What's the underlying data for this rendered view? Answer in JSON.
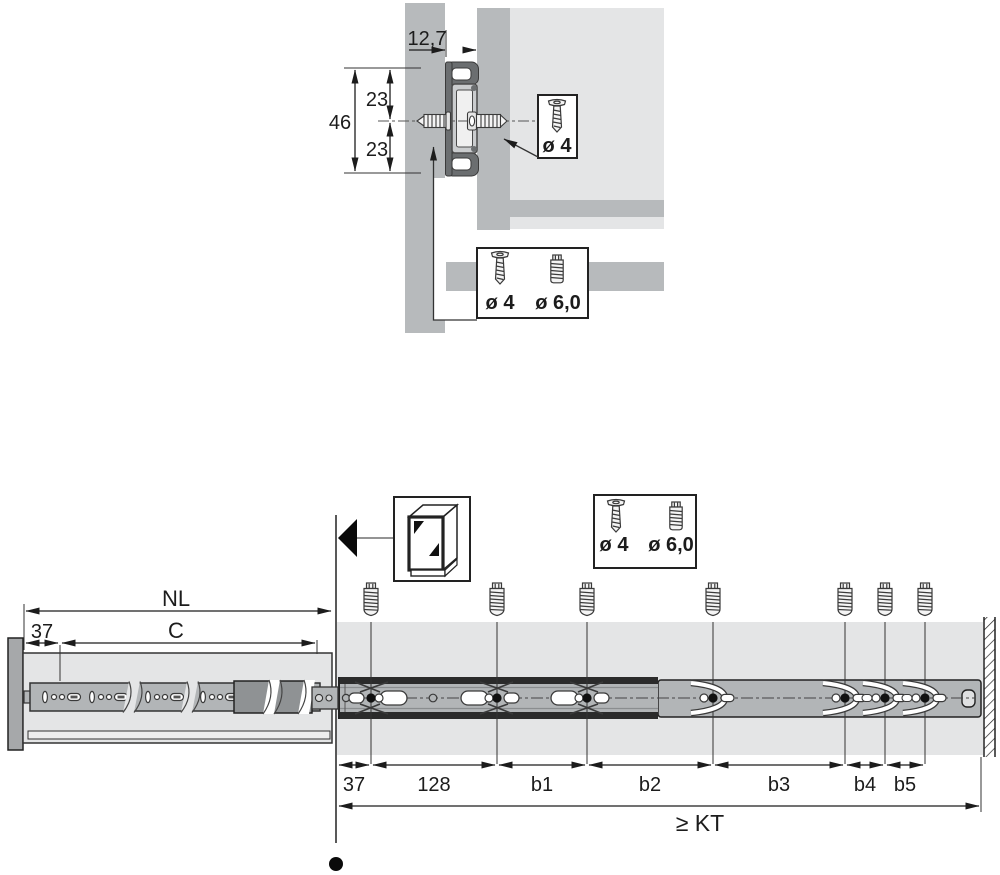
{
  "colors": {
    "panel_gray": "#b7babc",
    "panel_dark": "#a6a8aa",
    "light_gray": "#e4e5e6",
    "rail_gray": "#b2b5b7",
    "rail_dark": "#8f9294",
    "outline": "#222222",
    "black": "#111111"
  },
  "top": {
    "gap_width": "12,7",
    "height_total": "46",
    "height_upper": "23",
    "height_lower": "23",
    "box_drawer_screw": {
      "label": "ø 4",
      "icon": "countersunk-screw-icon"
    },
    "box_side_screws": {
      "label_1": "ø 4",
      "label_2": "ø 6,0",
      "icon_1": "countersunk-screw-icon",
      "icon_2": "pan-head-screw-icon"
    }
  },
  "bottom": {
    "len_nominal": "NL",
    "len_c": "C",
    "front_offset": "37",
    "cabinet_icon": "cabinet-3d-icon",
    "box_side_screws": {
      "label_1": "ø 4",
      "label_2": "ø 6,0"
    },
    "spacings": [
      "37",
      "128",
      "b1",
      "b2",
      "b3",
      "b4",
      "b5"
    ],
    "depth": "≥ KT"
  }
}
